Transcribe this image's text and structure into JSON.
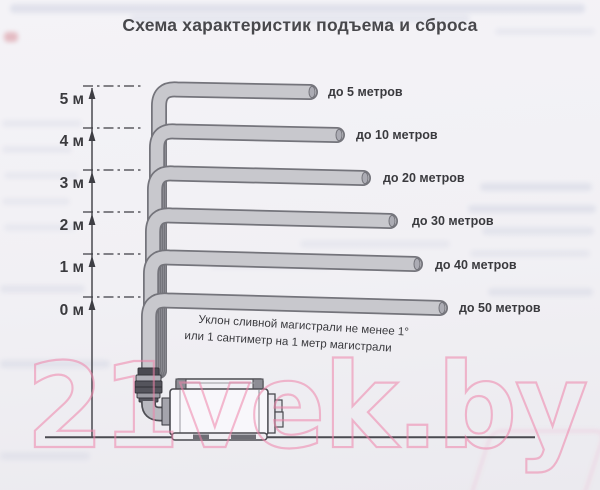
{
  "title": "Схема характеристик подъема и сброса",
  "watermark": "21vek.by",
  "note": {
    "line1": "Уклон сливной магистрали не менее 1°",
    "line2": "или 1 сантиметр на 1 метр магистрали"
  },
  "levels": [
    {
      "height_label": "5 м",
      "distance_label": "до 5 метров"
    },
    {
      "height_label": "4 м",
      "distance_label": "до 10 метров"
    },
    {
      "height_label": "3 м",
      "distance_label": "до 20 метров"
    },
    {
      "height_label": "2 м",
      "distance_label": "до 30 метров"
    },
    {
      "height_label": "1 м",
      "distance_label": "до 40 метров"
    },
    {
      "height_label": "0 м",
      "distance_label": "до 50 метров"
    }
  ],
  "colors": {
    "paper": "#f1f0f4",
    "ink": "#3e3e44",
    "pipe_fill": "#c8c8cd",
    "pipe_outline": "#74747b",
    "watermark_pink": "#ee84aa"
  }
}
